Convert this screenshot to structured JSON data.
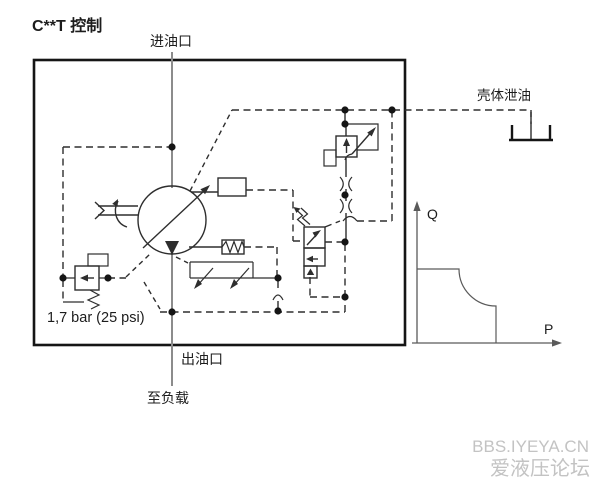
{
  "title": "C**T 控制",
  "labels": {
    "inlet_port": "进油口",
    "case_drain": "壳体泄油",
    "outlet_port": "出油口",
    "to_load": "至负载",
    "pressure_setting": "1,7 bar (25 psi)"
  },
  "graph": {
    "y_axis_label": "Q",
    "x_axis_label": "P"
  },
  "watermark": {
    "line1": "BBS.IYEYA.CN",
    "line2": "爱液压论坛"
  },
  "colors": {
    "line": "#2e2e2e",
    "border": "#151515",
    "flow": "#8c8c8c",
    "axis": "#5a5a5a",
    "watermark": "#c3c3c3"
  }
}
